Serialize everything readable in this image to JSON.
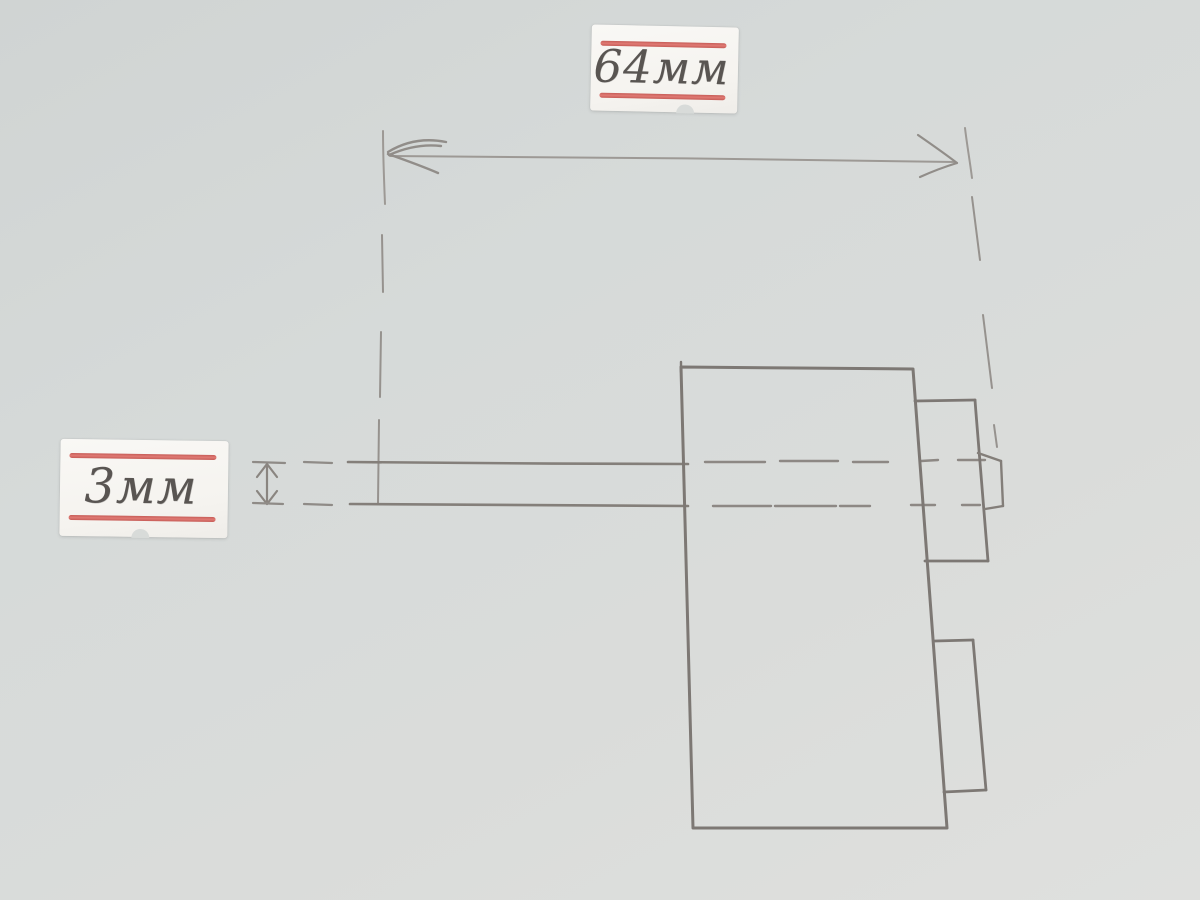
{
  "diagram": {
    "kind": "hand-drawn pencil dimension sketch",
    "dimensions": {
      "length": {
        "label": "64мм",
        "value": 64,
        "unit": "мм",
        "orientation": "horizontal"
      },
      "thickness": {
        "label": "3мм",
        "value": 3,
        "unit": "мм",
        "orientation": "vertical"
      }
    }
  },
  "colors": {
    "paper": "#d7dad8",
    "pencil_light": "#9d9995",
    "pencil_medium": "#8d8884",
    "pencil_dark": "#7d7874",
    "sticker_paper": "#f7f5f1",
    "sticker_stripe": "#d4625d",
    "handwriting": "#595552"
  }
}
